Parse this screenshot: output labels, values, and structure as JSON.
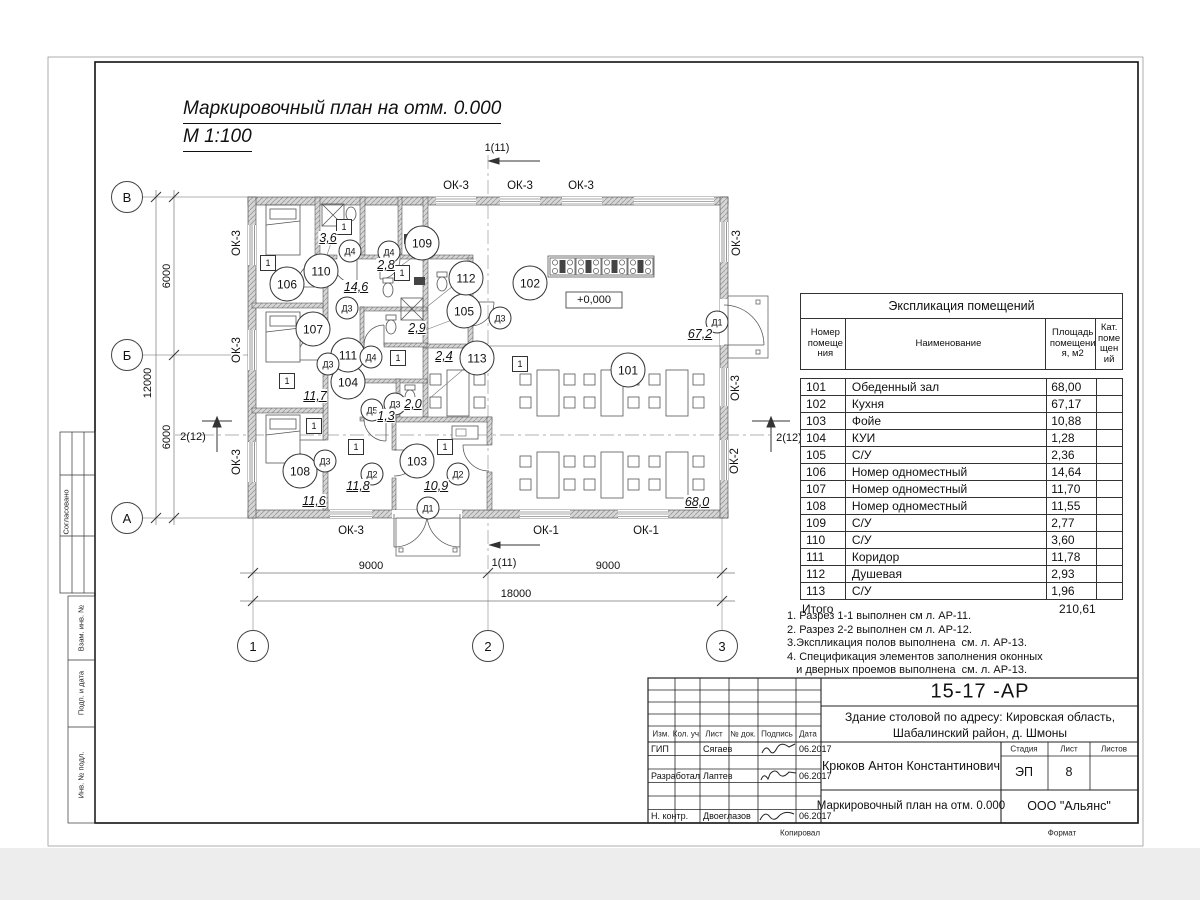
{
  "title": {
    "line1": "Маркировочный план  на отм. 0.000",
    "line2": "М 1:100"
  },
  "explication": {
    "title": "Экспликация помещений",
    "headers": {
      "num": "Номер\nпомеще\nния",
      "name": "Наименование",
      "area": "Площадь\nпомещени\nя, м2",
      "cat": "Кат.\nпоме\nщен\nий"
    },
    "rows": [
      {
        "num": "101",
        "name": "Обеденный зал",
        "area": "68,00"
      },
      {
        "num": "102",
        "name": "Кухня",
        "area": "67,17"
      },
      {
        "num": "103",
        "name": "Фойе",
        "area": "10,88"
      },
      {
        "num": "104",
        "name": "КУИ",
        "area": "1,28"
      },
      {
        "num": "105",
        "name": "С/У",
        "area": "2,36"
      },
      {
        "num": "106",
        "name": "Номер одноместный",
        "area": "14,64"
      },
      {
        "num": "107",
        "name": "Номер одноместный",
        "area": "11,70"
      },
      {
        "num": "108",
        "name": "Номер одноместный",
        "area": "11,55"
      },
      {
        "num": "109",
        "name": "С/У",
        "area": "2,77"
      },
      {
        "num": "110",
        "name": "С/У",
        "area": "3,60"
      },
      {
        "num": "111",
        "name": "Коридор",
        "area": "11,78"
      },
      {
        "num": "112",
        "name": "Душевая",
        "area": "2,93"
      },
      {
        "num": "113",
        "name": "С/У",
        "area": "1,96"
      }
    ],
    "total_label": "Итого",
    "total_value": "210,61"
  },
  "notes": [
    "1. Разрез 1-1 выполнен см л. АР-11.",
    "2. Разрез 2-2 выполнен см л. АР-12.",
    "3.Экспликация полов выполнена  см. л. АР-13.",
    "4. Спецификация элементов заполнения оконных",
    "   и дверных проемов выполнена  см. л. АР-13."
  ],
  "plan": {
    "wall_type_mark": "1",
    "elevation": "+0,000",
    "rooms": [
      {
        "v": "101",
        "x": 628,
        "y": 370
      },
      {
        "v": "102",
        "x": 530,
        "y": 283
      },
      {
        "v": "103",
        "x": 417,
        "y": 461
      },
      {
        "v": "104",
        "x": 348,
        "y": 382
      },
      {
        "v": "105",
        "x": 464,
        "y": 311
      },
      {
        "v": "106",
        "x": 287,
        "y": 284
      },
      {
        "v": "107",
        "x": 313,
        "y": 329
      },
      {
        "v": "108",
        "x": 300,
        "y": 471
      },
      {
        "v": "109",
        "x": 422,
        "y": 243
      },
      {
        "v": "110",
        "x": 321,
        "y": 271
      },
      {
        "v": "111",
        "x": 348,
        "y": 355
      },
      {
        "v": "112",
        "x": 466,
        "y": 278
      },
      {
        "v": "113",
        "x": 477,
        "y": 358
      }
    ],
    "doors": [
      {
        "v": "Д1",
        "x": 428,
        "y": 508
      },
      {
        "v": "Д1",
        "x": 717,
        "y": 322
      },
      {
        "v": "Д2",
        "x": 372,
        "y": 474
      },
      {
        "v": "Д2",
        "x": 458,
        "y": 474
      },
      {
        "v": "Д3",
        "x": 347,
        "y": 308
      },
      {
        "v": "Д3",
        "x": 328,
        "y": 364
      },
      {
        "v": "Д3",
        "x": 395,
        "y": 404
      },
      {
        "v": "Д3",
        "x": 325,
        "y": 461
      },
      {
        "v": "Д3",
        "x": 500,
        "y": 318
      },
      {
        "v": "Д4",
        "x": 350,
        "y": 251
      },
      {
        "v": "Д4",
        "x": 389,
        "y": 252
      },
      {
        "v": "Д4",
        "x": 371,
        "y": 357
      },
      {
        "v": "Д5",
        "x": 372,
        "y": 410
      }
    ],
    "areas": [
      {
        "v": "68,0",
        "x": 697,
        "y": 502
      },
      {
        "v": "67,2",
        "x": 700,
        "y": 334
      },
      {
        "v": "14,6",
        "x": 356,
        "y": 287
      },
      {
        "v": "3,6",
        "x": 328,
        "y": 238
      },
      {
        "v": "2,8",
        "x": 386,
        "y": 265
      },
      {
        "v": "2,9",
        "x": 417,
        "y": 328
      },
      {
        "v": "2,4",
        "x": 444,
        "y": 356
      },
      {
        "v": "2,0",
        "x": 413,
        "y": 404
      },
      {
        "v": "1,3",
        "x": 386,
        "y": 416
      },
      {
        "v": "11,7",
        "x": 315,
        "y": 396
      },
      {
        "v": "11,6",
        "x": 314,
        "y": 501
      },
      {
        "v": "11,8",
        "x": 358,
        "y": 486
      },
      {
        "v": "10,9",
        "x": 436,
        "y": 486
      }
    ],
    "type_marks": [
      {
        "x": 268,
        "y": 263
      },
      {
        "x": 344,
        "y": 227
      },
      {
        "x": 287,
        "y": 381
      },
      {
        "x": 314,
        "y": 426
      },
      {
        "x": 356,
        "y": 447
      },
      {
        "x": 402,
        "y": 273
      },
      {
        "x": 398,
        "y": 358
      },
      {
        "x": 445,
        "y": 447
      },
      {
        "x": 520,
        "y": 364
      }
    ],
    "windows": [
      {
        "v": "ОК-3",
        "x": 456,
        "y": 186,
        "r": 0
      },
      {
        "v": "ОК-3",
        "x": 520,
        "y": 186,
        "r": 0
      },
      {
        "v": "ОК-3",
        "x": 581,
        "y": 186,
        "r": 0
      },
      {
        "v": "ОК-3",
        "x": 237,
        "y": 243,
        "r": 1
      },
      {
        "v": "ОК-3",
        "x": 237,
        "y": 350,
        "r": 1
      },
      {
        "v": "ОК-3",
        "x": 237,
        "y": 462,
        "r": 1
      },
      {
        "v": "ОК-3",
        "x": 737,
        "y": 243,
        "r": 1
      },
      {
        "v": "ОК-3",
        "x": 736,
        "y": 388,
        "r": 1
      },
      {
        "v": "ОК-2",
        "x": 735,
        "y": 461,
        "r": 1
      },
      {
        "v": "ОК-3",
        "x": 351,
        "y": 531,
        "r": 0
      },
      {
        "v": "ОК-1",
        "x": 546,
        "y": 531,
        "r": 0
      },
      {
        "v": "ОК-1",
        "x": 646,
        "y": 531,
        "r": 0
      }
    ],
    "dims": [
      {
        "v": "9000",
        "x": 371,
        "y": 566,
        "r": 0
      },
      {
        "v": "9000",
        "x": 608,
        "y": 566,
        "r": 0
      },
      {
        "v": "18000",
        "x": 516,
        "y": 594,
        "r": 0
      },
      {
        "v": "6000",
        "x": 167,
        "y": 276,
        "r": 1
      },
      {
        "v": "6000",
        "x": 167,
        "y": 437,
        "r": 1
      },
      {
        "v": "12000",
        "x": 148,
        "y": 383,
        "r": 1
      }
    ],
    "sections": [
      {
        "v": "1(11)",
        "x": 497,
        "y": 148
      },
      {
        "v": "1(11)",
        "x": 504,
        "y": 563
      },
      {
        "v": "2(12)",
        "x": 193,
        "y": 437
      },
      {
        "v": "2(12)",
        "x": 789,
        "y": 438
      }
    ],
    "axes": [
      {
        "v": "В",
        "x": 127,
        "y": 197
      },
      {
        "v": "Б",
        "x": 127,
        "y": 355
      },
      {
        "v": "А",
        "x": 127,
        "y": 518
      },
      {
        "v": "1",
        "x": 253,
        "y": 646
      },
      {
        "v": "2",
        "x": 488,
        "y": 646
      },
      {
        "v": "3",
        "x": 722,
        "y": 646
      }
    ]
  },
  "stamp_left": {
    "approve": "Согласовано",
    "vzam": "Взам. инв. №",
    "podp": "Подп. и дата",
    "inv": "Инв. № подл."
  },
  "titleblock": {
    "doc_code": "15-17 -АР",
    "project_line1": "Здание столовой по адресу: Кировская область,",
    "project_line2": "Шабалинский район, д. Шмоны",
    "chief": "Крюков Антон Константинович",
    "stage_label": "Стадия",
    "sheet_label": "Лист",
    "sheets_label": "Листов",
    "stage": "ЭП",
    "sheet_num": "8",
    "drawing_title": "Маркировочный план  на отм. 0.000",
    "company": "ООО \"Альянс\"",
    "cols": [
      "Изм.",
      "Кол. уч.",
      "Лист",
      "№ док.",
      "Подпись",
      "Дата"
    ],
    "persons": [
      {
        "role": "ГИП",
        "name": "Сягаев",
        "date": "06.2017"
      },
      {
        "role": "Разработал",
        "name": "Лаптев",
        "date": "06.2017"
      },
      {
        "role": "Н. контр.",
        "name": "Двоеглазов",
        "date": "06.2017"
      }
    ],
    "footer": {
      "kopiroval": "Копировал",
      "format": "Формат"
    }
  }
}
